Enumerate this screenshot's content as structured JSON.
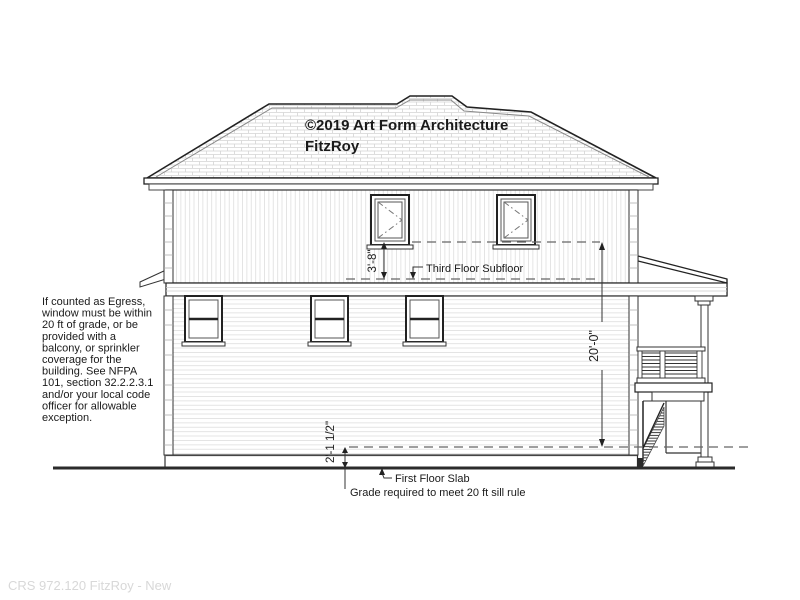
{
  "title": {
    "copyright": "©2019 Art Form Architecture",
    "model": "FitzRoy"
  },
  "egress_note": {
    "lines": [
      "If counted as Egress,",
      "window must be within",
      "20 ft of grade, or be",
      "provided with a",
      "balcony, or sprinkler",
      "coverage for the",
      "building.  See NFPA",
      "101, section 32.2.2.3.1",
      "and/or your local code",
      "officer for allowable",
      "exception."
    ]
  },
  "dimensions": {
    "sill_to_subfloor": "3'-8\"",
    "sill_to_grade": "20'-0\"",
    "grade_to_slab": "2'-1 1/2\""
  },
  "labels": {
    "third_floor_subfloor": "Third Floor Subfloor",
    "first_floor_slab": "First Floor Slab",
    "grade_note": "Grade required to meet 20 ft sill rule"
  },
  "footer": {
    "drawing_id": "CRS 972.120 FitzRoy - New"
  },
  "colors": {
    "line": "#1a1a1a",
    "siding_line": "#e0e0e0",
    "roof_hatch": "#d4d4d4",
    "dashed_line": "#666666",
    "footer_text": "#d8d8d8",
    "background": "#ffffff"
  }
}
